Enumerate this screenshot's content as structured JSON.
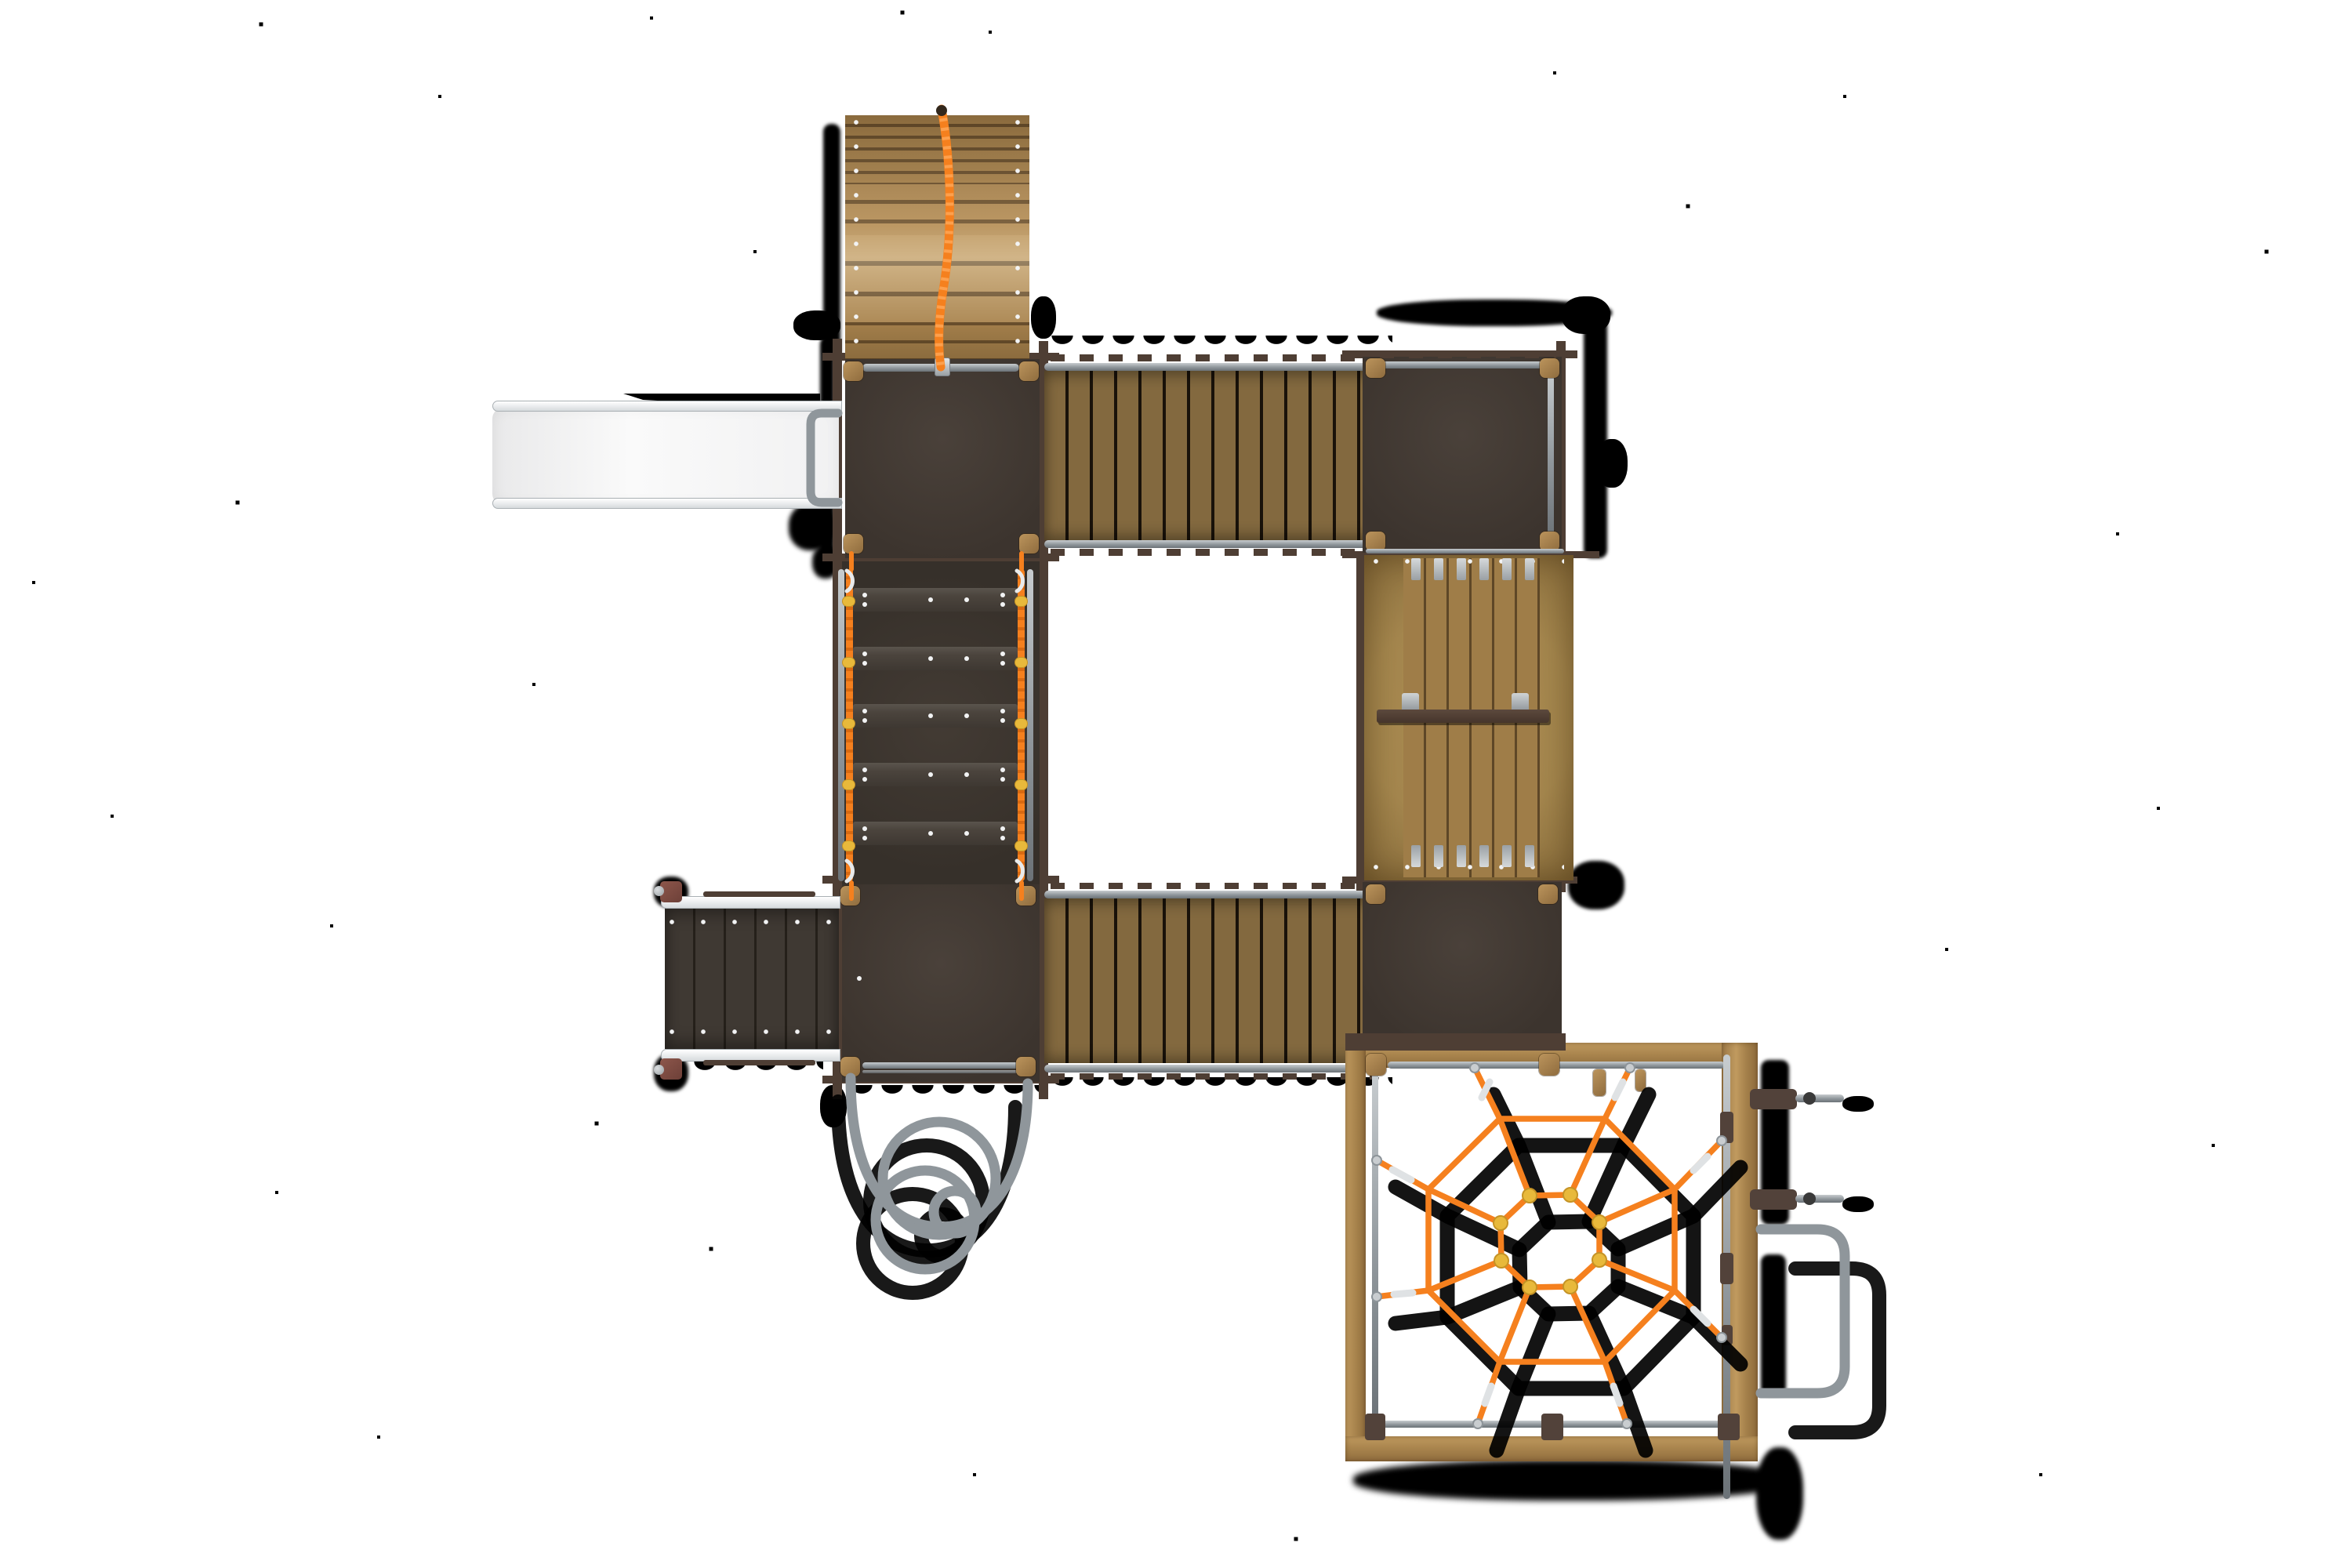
{
  "scene": {
    "title": "playground play structure - top view render",
    "background": "#ffffff"
  },
  "colors": {
    "bg": "#ffffff",
    "deck": "#453d36",
    "deck2": "#3c342e",
    "frame": "#4e3e34",
    "bridgewood": "#83693f",
    "bridgegap": "#19120a",
    "archwood": "#b08a53",
    "archgap": "#6e5331",
    "rampwood": "#a5874e",
    "rampplank": "#9f7d48",
    "rampgap": "#5e4727",
    "framewood": "#b08b54",
    "capwood": "#a8834d",
    "stepbar": "#4b443d",
    "orange": "#f5801e",
    "orangedark": "#d96a12",
    "yellow": "#e8b93b",
    "metal": "#8f969b",
    "metallight": "#c7cccf",
    "metaldark": "#6b7277",
    "railwhite": "#e9eced",
    "slidewhite": "#f7f7f7",
    "slideshade": "#e4e6e7",
    "redcap": "#7d4a40",
    "darkpad": "#52423a",
    "screw": "#f2f3f4",
    "shadow": "#000000"
  },
  "components": [
    {
      "id": "arch-climber",
      "label": "arch climber with centre rope"
    },
    {
      "id": "upper-left-platform",
      "label": "upper left deck platform"
    },
    {
      "id": "slide",
      "label": "straight slide"
    },
    {
      "id": "slide-hoop",
      "label": "slide entry hoop"
    },
    {
      "id": "upper-bridge",
      "label": "timber plank bridge (upper)"
    },
    {
      "id": "upper-right-platform",
      "label": "upper right deck platform"
    },
    {
      "id": "timber-ramp",
      "label": "timber climbing ramp with grab bar"
    },
    {
      "id": "step-ramp",
      "label": "step ramp with rope hand rails"
    },
    {
      "id": "lower-left-platform",
      "label": "lower left deck platform"
    },
    {
      "id": "side-ramp",
      "label": "side access ramp"
    },
    {
      "id": "lower-bridge",
      "label": "timber plank bridge (lower)"
    },
    {
      "id": "lower-right-platform",
      "label": "lower right deck platform"
    },
    {
      "id": "web-frame",
      "label": "timber frame of web climber"
    },
    {
      "id": "spider-web",
      "label": "spider web rope climber"
    },
    {
      "id": "loop-climber",
      "label": "loop climber tubes"
    },
    {
      "id": "grab-handle",
      "label": "metal grab handle"
    },
    {
      "id": "peg-steps",
      "label": "metal peg steps"
    }
  ]
}
